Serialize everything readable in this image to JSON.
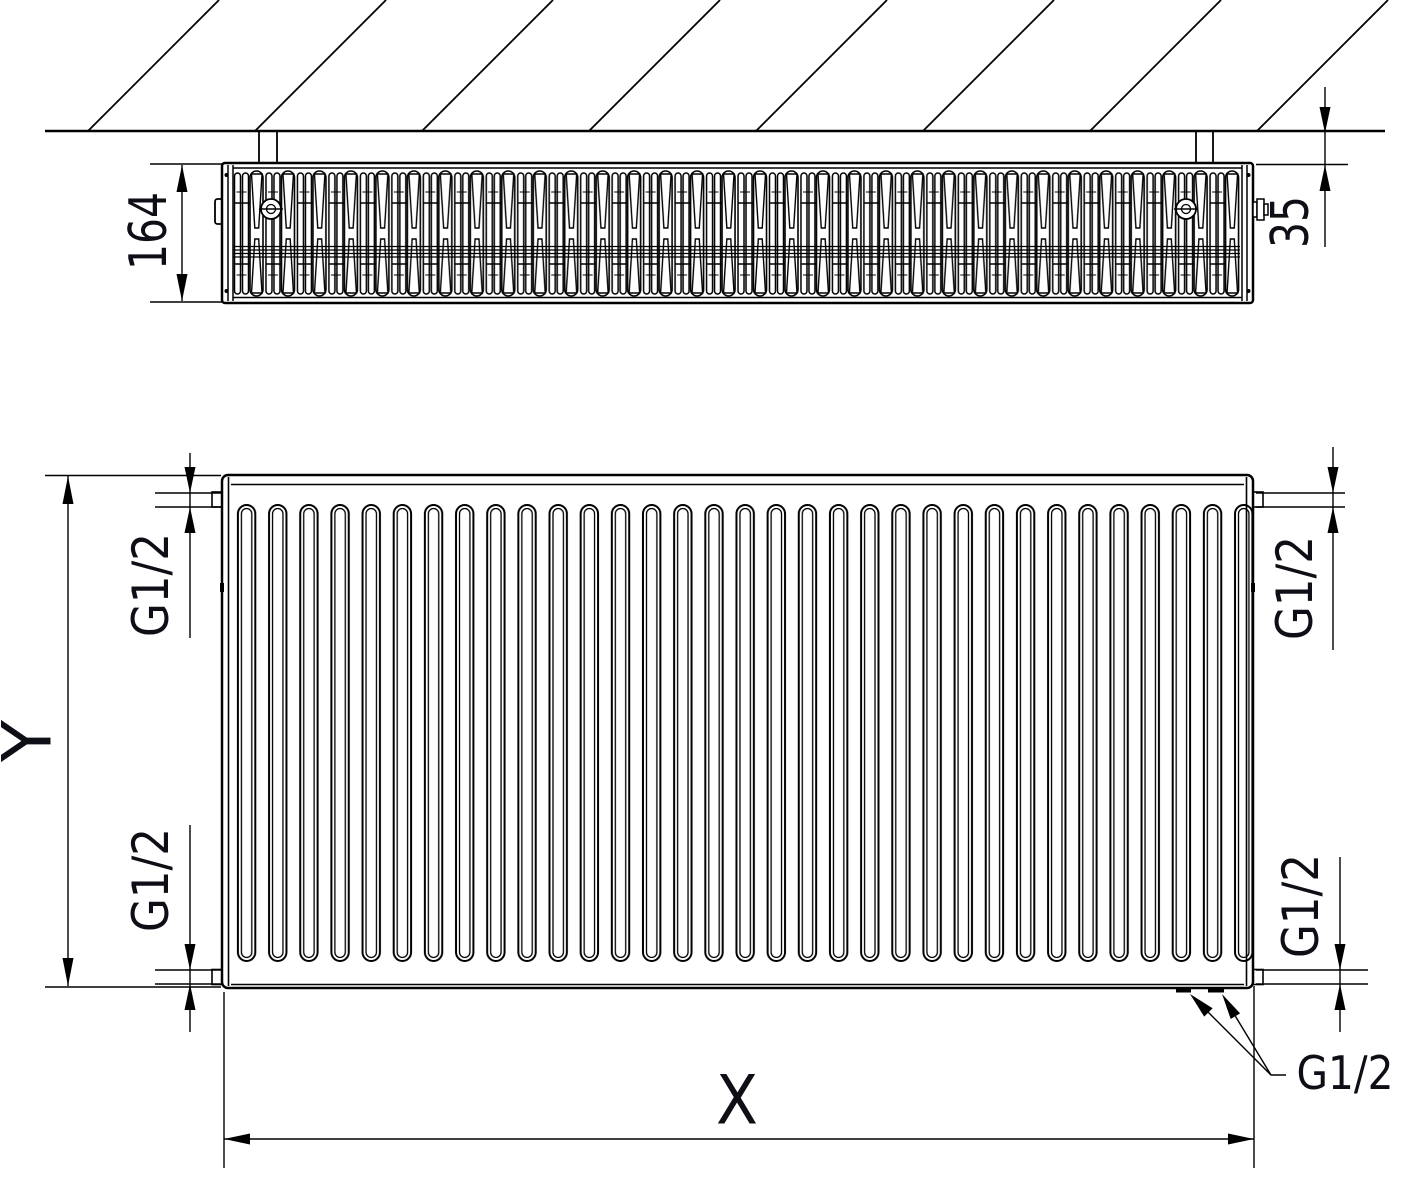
{
  "meta": {
    "title": "Panel radiator technical dimension drawing"
  },
  "top_view": {
    "depth": "164",
    "wall_distance": "35"
  },
  "front_view": {
    "height": "Y",
    "width": "X",
    "conn_top_left": "G1/2",
    "conn_bottom_left": "G1/2",
    "conn_top_right": "G1/2",
    "conn_bottom_right": "G1/2",
    "conn_bottom": "G1/2"
  },
  "colors": {
    "line": "#000000",
    "text": "#0e0e16",
    "background": "#ffffff"
  }
}
